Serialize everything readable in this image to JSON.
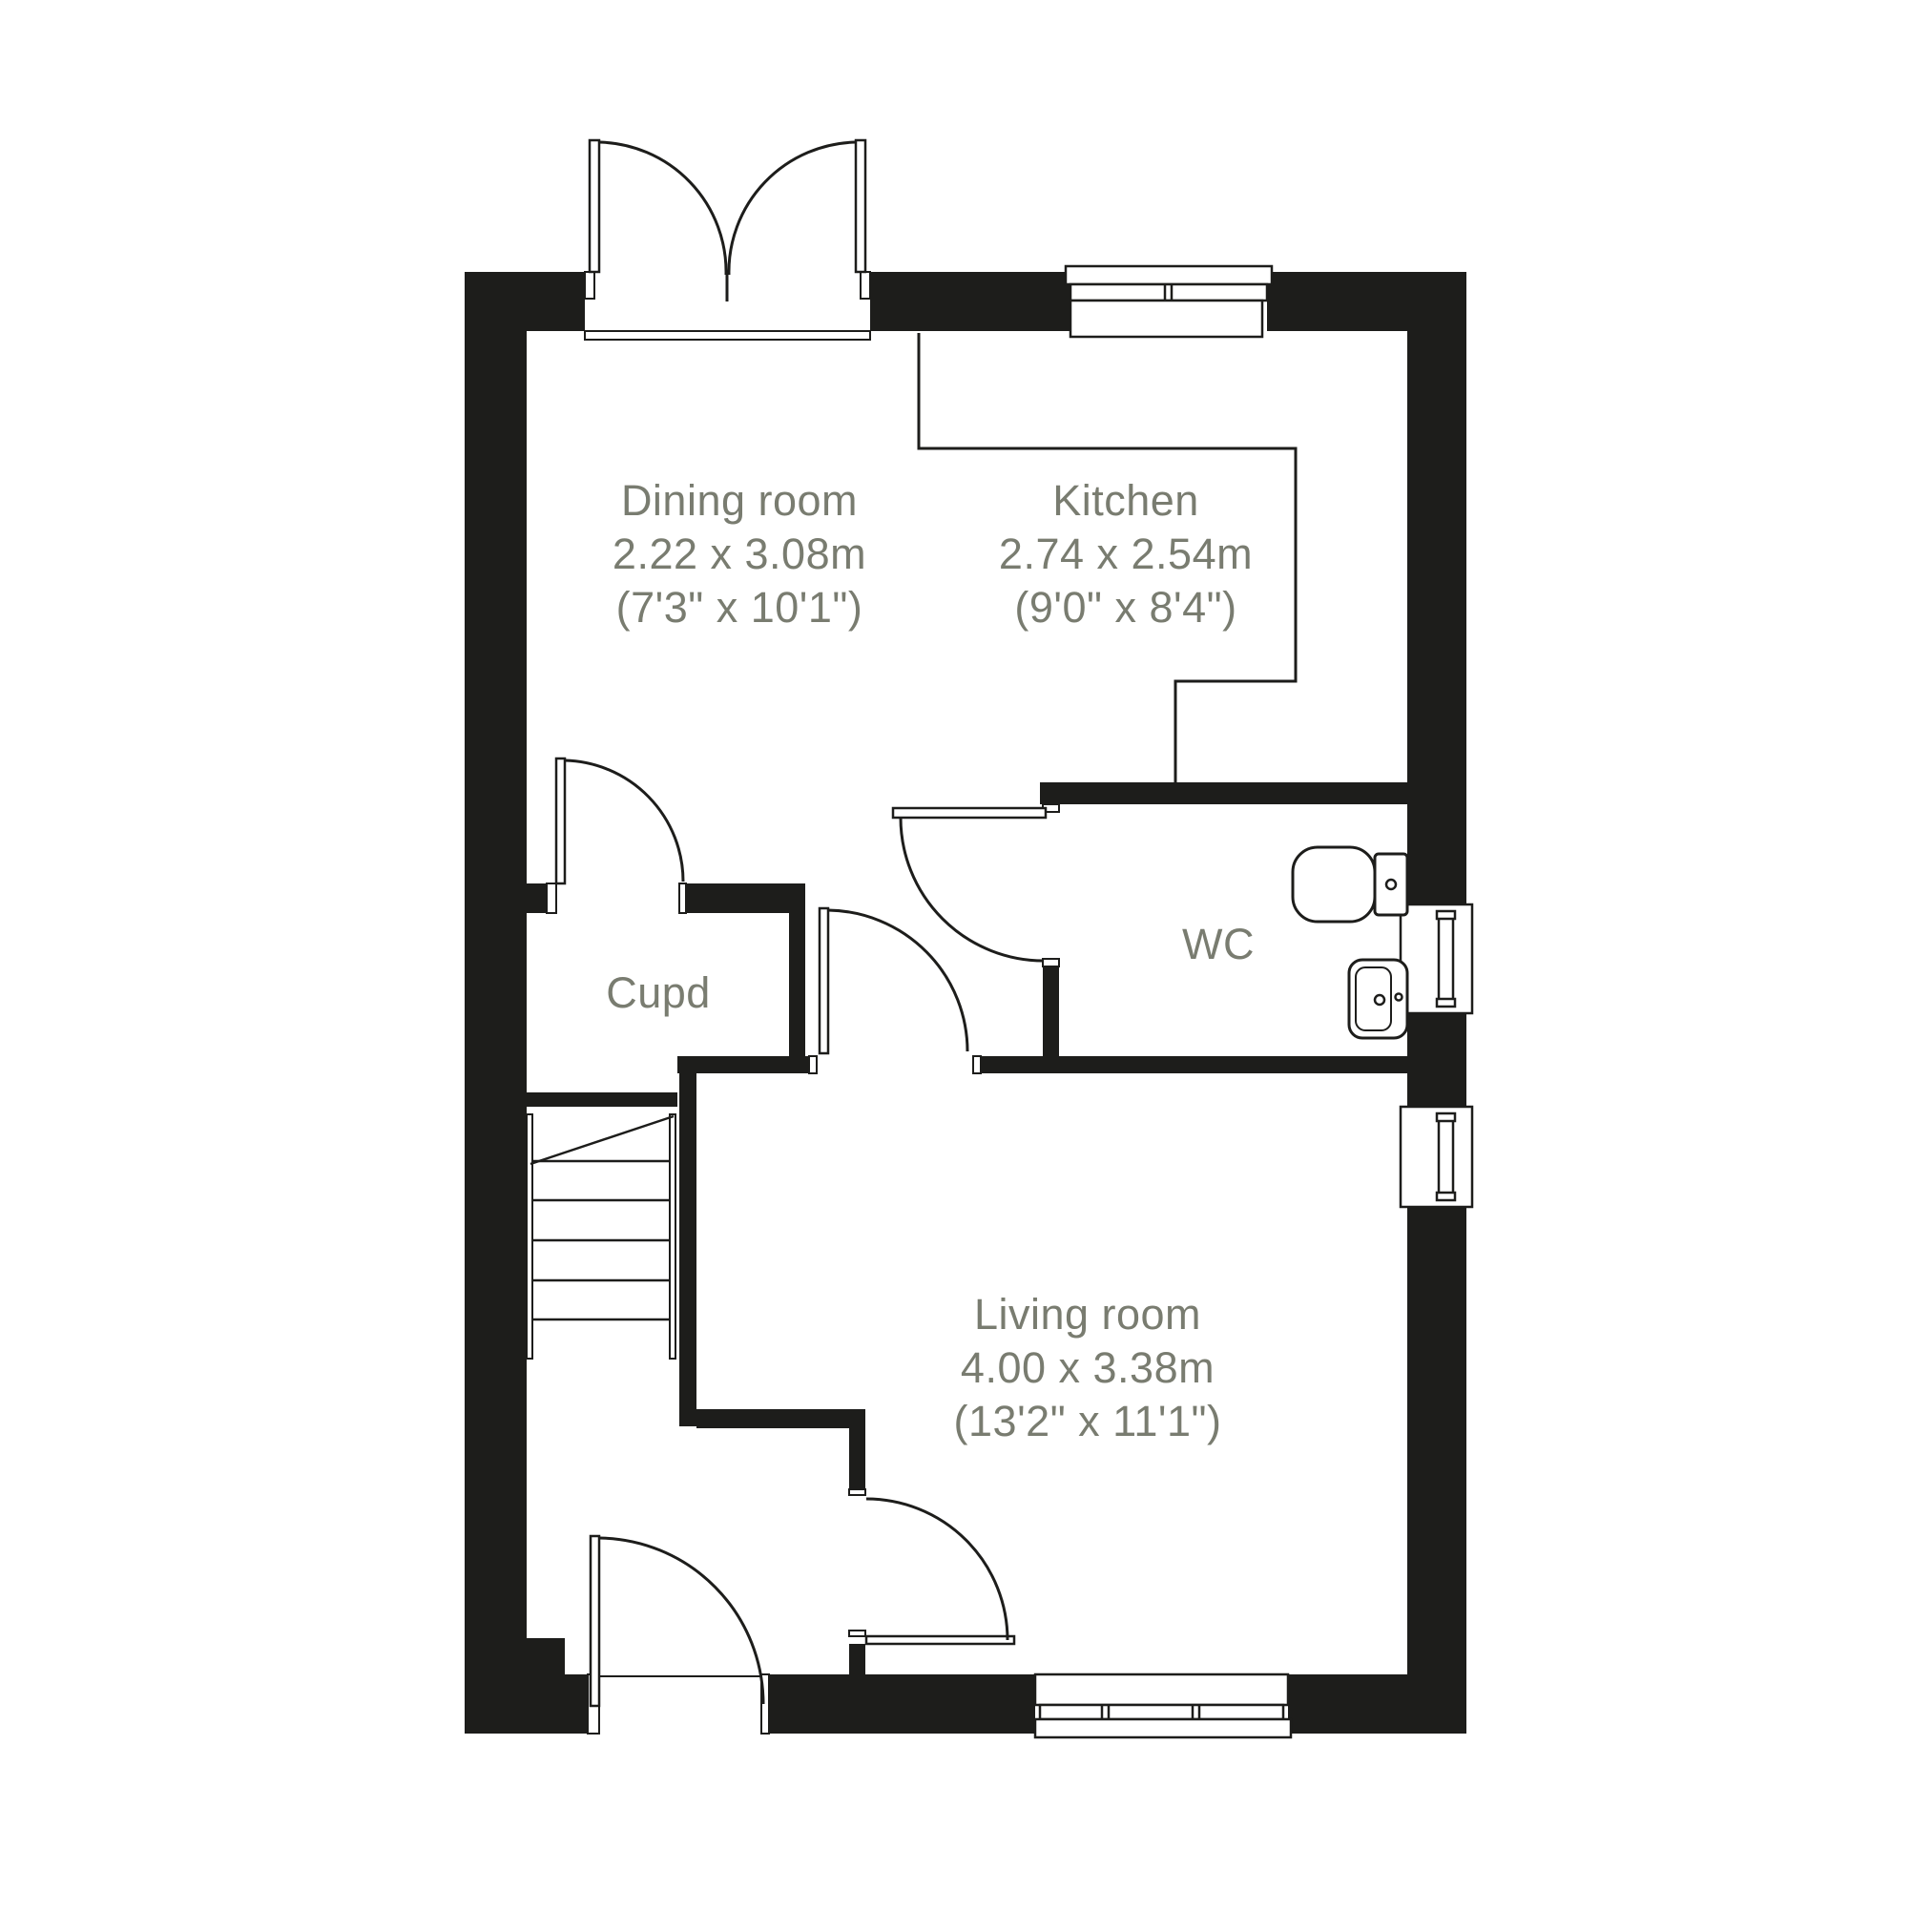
{
  "plan": {
    "title": "Ground floor plan",
    "wall_color": "#1d1d1b",
    "line_color": "#1d1d1b",
    "label_color": "#797c70",
    "background_color": "#ffffff"
  },
  "rooms": {
    "dining": {
      "name": "Dining room",
      "dimensions_metric": "2.22 x 3.08m",
      "dimensions_imperial": "(7'3\" x 10'1\")"
    },
    "kitchen": {
      "name": "Kitchen",
      "dimensions_metric": "2.74 x 2.54m",
      "dimensions_imperial": "(9'0\" x 8'4\")"
    },
    "wc": {
      "name": "WC"
    },
    "cupboard": {
      "name": "Cupd"
    },
    "living": {
      "name": "Living room",
      "dimensions_metric": "4.00 x 3.38m",
      "dimensions_imperial": "(13'2\" x 11'1\")"
    }
  }
}
